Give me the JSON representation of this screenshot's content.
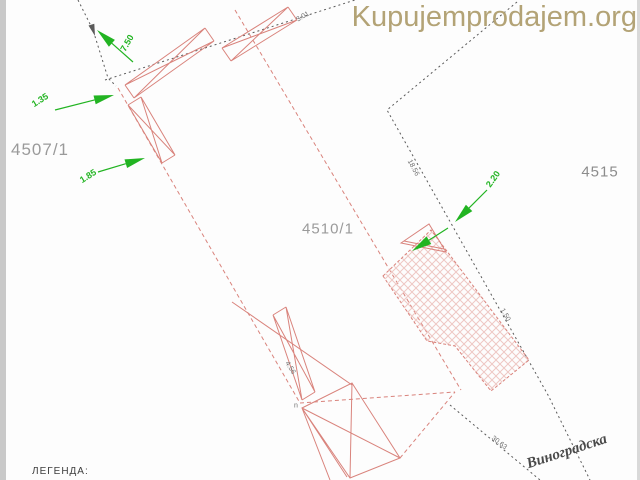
{
  "watermark": {
    "text": "Kupujemprodajem.org"
  },
  "parcels": {
    "p4507": "4507/1",
    "p4510": "4510/1",
    "p4515": "4515"
  },
  "dims": {
    "d750": "7.50",
    "d135": "1.35",
    "d185": "1.85",
    "d220": "2.20"
  },
  "small_dims": {
    "s301": "3.01",
    "s1856": "18.56",
    "s150": "1.50",
    "s456": "4.56",
    "s3063": "30.63",
    "vertex": "n"
  },
  "legend": {
    "title": "ЛЕГЕНДА:"
  },
  "street": {
    "name": "Виноградска"
  },
  "colors": {
    "boundary_red": "#d9837c",
    "survey_black": "#5a5a5a",
    "dimension_green": "#22b422",
    "hatch_pink": "#eec7c3",
    "label_gray": "#9a9a9a",
    "watermark_tan": "#b3a376"
  }
}
